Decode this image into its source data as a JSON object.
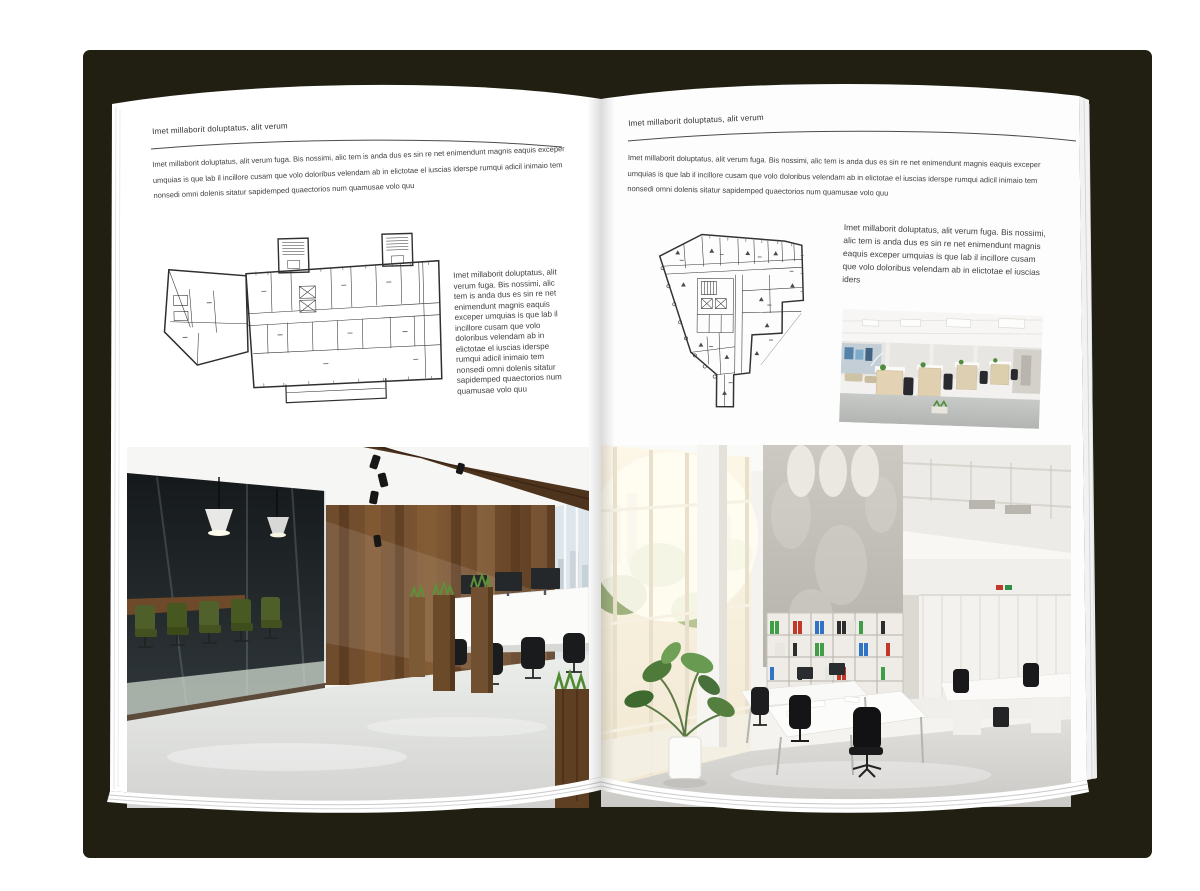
{
  "document": {
    "type": "magazine-spread-mockup",
    "cover_color": "#201f12",
    "page_color": "#ffffff"
  },
  "pages": [
    {
      "id": "left",
      "header": "Imet millaborit doluptatus, alit verum",
      "intro": "Imet millaborit doluptatus, alit verum fuga. Bis nossimi, alic tem is anda dus es sin re net enimendunt magnis eaquis exceper umquias is que lab il incillore cusam que volo doloribus velendam ab in elictotae el iuscias iderspe rumqui adicil inimaio tem nonsedi omni dolenis sitatur sapidemped quaectorios num quamusae volo quu",
      "figure": {
        "name": "floor-plan-wide-building"
      },
      "side_text": "Imet millaborit doluptatus, alit verum fuga. Bis nossimi, alic tem is anda dus es sin re net enimendunt magnis eaquis exceper umquias is que lab il incillore cusam que volo doloribus velendam ab in elictotae el iuscias iderspe rumqui adicil inimaio tem nonsedi omni dolenis sitatur sapidemped quaectorios num quamusae volo quu",
      "photo": {
        "name": "office-photo-dark-glass-meeting-room"
      }
    },
    {
      "id": "right",
      "header": "Imet millaborit doluptatus, alit verum",
      "intro": "Imet millaborit doluptatus, alit verum fuga. Bis nossimi, alic tem is anda dus es sin re net enimendunt magnis eaquis exceper umquias is que lab il incillore cusam que volo doloribus velendam ab in elictotae el iuscias iderspe rumqui adicil inimaio tem nonsedi omni dolenis sitatur sapidemped quaectorios num quamusae volo quu",
      "figure": {
        "name": "floor-plan-irregular-building"
      },
      "side_text": "Imet millaborit doluptatus, alit verum fuga. Bis nossimi, alic tem is anda dus es sin re net eni­mendunt magnis eaquis exceper umquias is que lab il incillore cusam que volo doloribus velendam ab in elictotae el iuscias iders",
      "photo_small": {
        "name": "office-photo-white-workstations"
      },
      "photo": {
        "name": "office-photo-bright-loft"
      }
    }
  ]
}
